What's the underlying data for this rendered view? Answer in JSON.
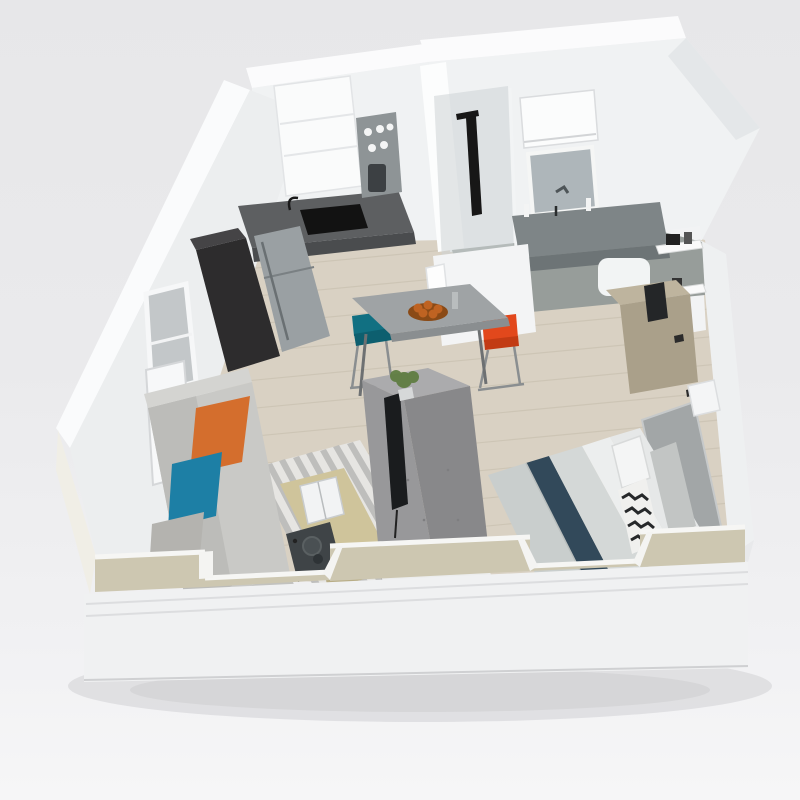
{
  "scene": {
    "title": "Isometric 3D cutaway floor plan of a studio apartment",
    "view": "dollhouse cutaway render",
    "rooms": [
      {
        "name": "kitchen",
        "items": [
          "tall dark cabinet",
          "stainless refrigerator",
          "dark countertop with sink and faucet",
          "white oven tower",
          "open shelf niche with jars"
        ]
      },
      {
        "name": "dining",
        "items": [
          "gray bar table",
          "fruit bowl",
          "teal bar chair",
          "orange bar chair"
        ]
      },
      {
        "name": "living-room",
        "items": [
          "gray sofa",
          "orange pillow",
          "teal pillow",
          "gray pillow",
          "striped area rug",
          "wood coffee table",
          "open book",
          "dark serving tray",
          "concrete media partition",
          "flat TV",
          "plant"
        ]
      },
      {
        "name": "bedroom",
        "items": [
          "bed with layered bedding",
          "navy runner",
          "chevron pillow",
          "gray headboard",
          "tan dresser",
          "white nightstand",
          "wall hooks"
        ]
      },
      {
        "name": "bathroom",
        "items": [
          "walk-in shower with black column",
          "glass partition",
          "gray vanity counter",
          "LED mirror",
          "medicine cabinet",
          "toilet",
          "pony wall with towel",
          "wall shelf"
        ]
      }
    ],
    "shell": [
      "white exterior walls",
      "chamfered corner wall",
      "window on left wall",
      "entry door",
      "beige cutaway front wall with two notches",
      "white base plinth",
      "light wood plank floor"
    ]
  },
  "palette": {
    "background": "#eaeaec",
    "wall_white": "#f0f2f3",
    "wall_top_white": "#fafbfc",
    "floor_wood": "#d9d1c3",
    "floor_plank_line": "#c4bcab",
    "bathroom_floor": "#979d9a",
    "counter_dark": "#5d5f61",
    "counter_front": "#4a4c4e",
    "cabinet_dark": "#2d2c2d",
    "fridge_steel": "#9aa0a3",
    "concrete_gray": "#98989a",
    "concrete_side": "#88888a",
    "tv_black": "#1a1c1e",
    "plant_green": "#5d7c3f",
    "rug_light": "#e6e5e2",
    "rug_dark": "#b5b5b3",
    "table_wood": "#cfc49b",
    "tray_dark": "#3f4447",
    "sofa_gray": "#c9c9c6",
    "pillow_orange": "#d46e2d",
    "pillow_teal": "#1d7fa5",
    "pillow_gray": "#b4b3af",
    "chair_teal": "#117082",
    "chair_orange": "#e2481c",
    "fruit_orange": "#bf6322",
    "bed_duvet": "#c9cecd",
    "bed_navy": "#32495a",
    "bed_light": "#d4d8d7",
    "bed_white": "#eceeee",
    "headboard_gray": "#a2a6a7",
    "desk_tan": "#beb49e",
    "mirror_glass": "#aeb6ba",
    "shower_glass": "#cdd3d5",
    "front_wall_beige": "#cdc7b1",
    "plinth_white": "#f0f1f2",
    "shadow_gray": "#d6d6d8"
  }
}
